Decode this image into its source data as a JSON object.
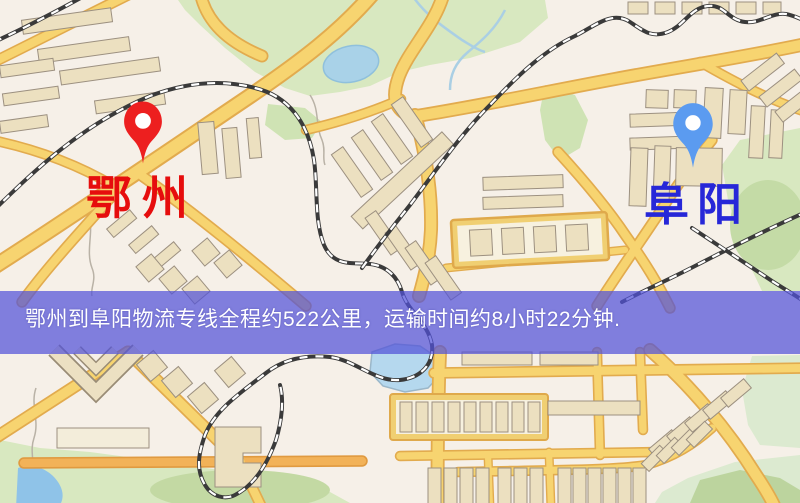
{
  "map": {
    "markers": {
      "origin": {
        "label": "鄂州",
        "pin_color": "#ed1f1f",
        "label_color": "#e60d0d"
      },
      "destination": {
        "label": "阜阳",
        "pin_color": "#5b9bf0",
        "label_color": "#2727d8"
      }
    },
    "banner": {
      "text": "鄂州到阜阳物流专线全程约522公里，运输时间约8小时22分钟.",
      "overlay_color": "rgba(82,82,216,0.72)",
      "text_color": "#ffffff",
      "distance_text": "约522公里",
      "duration_text": "约8小时22分钟"
    },
    "palette": {
      "land": "#f6f0e8",
      "road_fill": "#f7d470",
      "road_border": "#e2ab4e",
      "road_orange": "#f2b258",
      "park": "#d8e8c0",
      "park_dark": "#c3d9a3",
      "water": "#a9d2e8",
      "railway": "#3a3a3a",
      "building": "#ece0c0",
      "building_border": "#9c9080"
    }
  }
}
